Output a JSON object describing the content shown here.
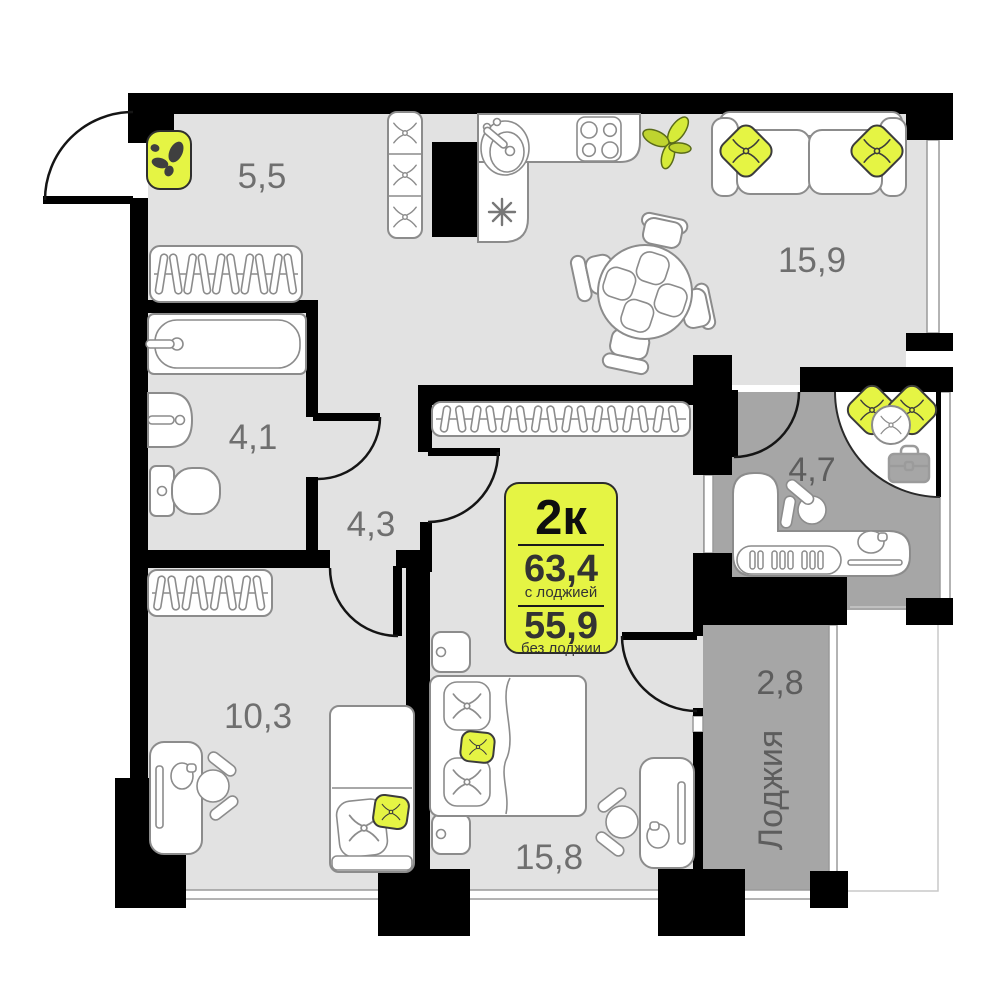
{
  "plan": {
    "badge": {
      "type": "2к",
      "area_with_loggia": "63,4",
      "with_note": "с лоджией",
      "area_without_loggia": "55,9",
      "without_note": "без лоджии"
    },
    "rooms": {
      "hallway": "5,5",
      "living_kitchen": "15,9",
      "bathroom": "4,1",
      "corridor": "4,3",
      "office": "4,7",
      "room": "10,3",
      "bedroom": "15,8",
      "loggia_area": "2,8",
      "loggia_name": "Лоджия"
    },
    "colors": {
      "accent_yellow": "#e5f444",
      "floor_light": "#e2e2e2",
      "floor_cold": "#a6a6a6",
      "wall_black": "#000000",
      "furniture_outline": "#8c8c8c",
      "label_gray": "#6f6f6f"
    }
  }
}
